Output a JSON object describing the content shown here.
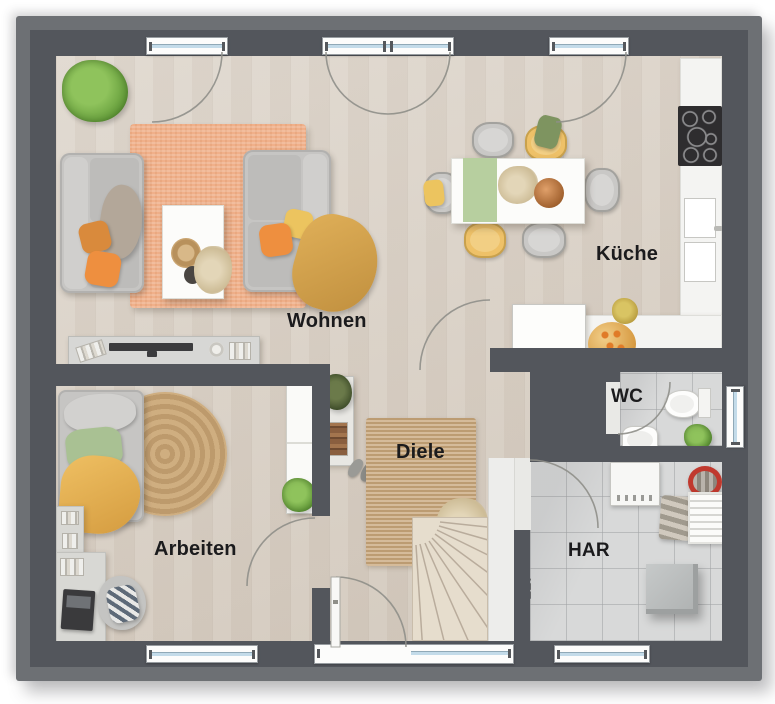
{
  "title": "Erdgeschoss Grundriss",
  "rooms": {
    "wohnen": {
      "label": "Wohnen"
    },
    "kueche": {
      "label": "Küche"
    },
    "arbeiten": {
      "label": "Arbeiten"
    },
    "diele": {
      "label": "Diele"
    },
    "wc": {
      "label": "WC"
    },
    "har": {
      "label": "HAR"
    },
    "elt": {
      "label": "ELT"
    }
  },
  "colors": {
    "wall": "#53565c",
    "wall_outer_step": "#6d7074",
    "wood_floor": "#dad1c6",
    "tile_floor": "#d8d9d9",
    "rug_orange": "#f0b08a",
    "rug_jute": "#c9a87e",
    "sofa_gray": "#c6c5c3",
    "accent_orange": "#ee8f3f",
    "accent_yellow": "#ecc166",
    "accent_green": "#a9c193",
    "blanket_mustard": "#d9a84e",
    "plant_green": "#6fa844",
    "window_glass": "#c3dbe9",
    "label_text": "#1b1b1d",
    "basket_red": "#c0392e"
  },
  "furniture": [
    "palm-plant",
    "orange-rug",
    "sofa-left",
    "sofa-right",
    "coffee-table",
    "sideboard-tv",
    "dining-table",
    "dining-chairs",
    "kitchen-counter",
    "cooktop",
    "kitchen-sink",
    "kitchen-appliance",
    "fruit-bowl",
    "daybed",
    "round-jute-rug",
    "wardrobe",
    "desk",
    "laptop",
    "office-chair",
    "book-shelf",
    "coat-rack",
    "shoes",
    "hall-jute-rug",
    "dried-grass",
    "winder-staircase",
    "entrance-door",
    "toilet",
    "hand-basin",
    "wc-plant",
    "washing-machine",
    "laundry-basket-red",
    "towel-stack",
    "drying-rack",
    "storage-box"
  ]
}
